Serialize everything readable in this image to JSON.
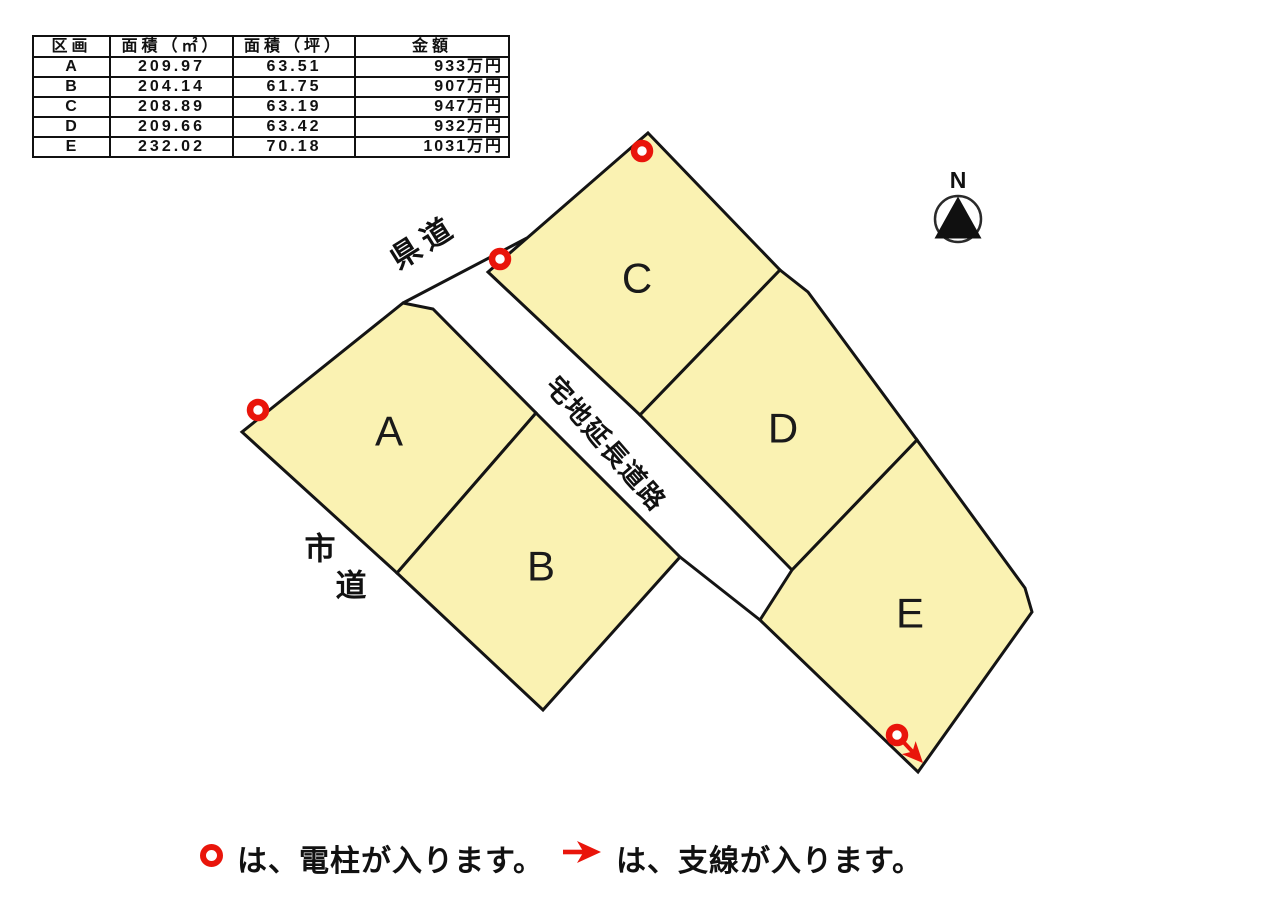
{
  "table": {
    "headers": [
      "区画",
      "面積（㎡）",
      "面積（坪）",
      "金額"
    ],
    "rows": [
      {
        "lot": "A",
        "area_sqm": "209.97",
        "area_tsubo": "63.51",
        "price": "933万円"
      },
      {
        "lot": "B",
        "area_sqm": "204.14",
        "area_tsubo": "61.75",
        "price": "907万円"
      },
      {
        "lot": "C",
        "area_sqm": "208.89",
        "area_tsubo": "63.19",
        "price": "947万円"
      },
      {
        "lot": "D",
        "area_sqm": "209.66",
        "area_tsubo": "63.42",
        "price": "932万円"
      },
      {
        "lot": "E",
        "area_sqm": "232.02",
        "area_tsubo": "70.18",
        "price": "1031万円"
      }
    ]
  },
  "diagram": {
    "parcels": {
      "a": {
        "label": "A"
      },
      "b": {
        "label": "B"
      },
      "c": {
        "label": "C"
      },
      "d": {
        "label": "D"
      },
      "e": {
        "label": "E"
      }
    },
    "roads": {
      "prefectural_road": "県道",
      "extension_road": "宅地延長道路",
      "city_road_char1": "市",
      "city_road_char2": "道"
    },
    "north_label": "N"
  },
  "legend": {
    "pole_text": "は、電柱が入ります。",
    "wire_text": "は、支線が入ります。"
  },
  "colors": {
    "parcel_fill": "#faf2b2",
    "line_black": "#141414",
    "marker_red": "#e9150b"
  }
}
